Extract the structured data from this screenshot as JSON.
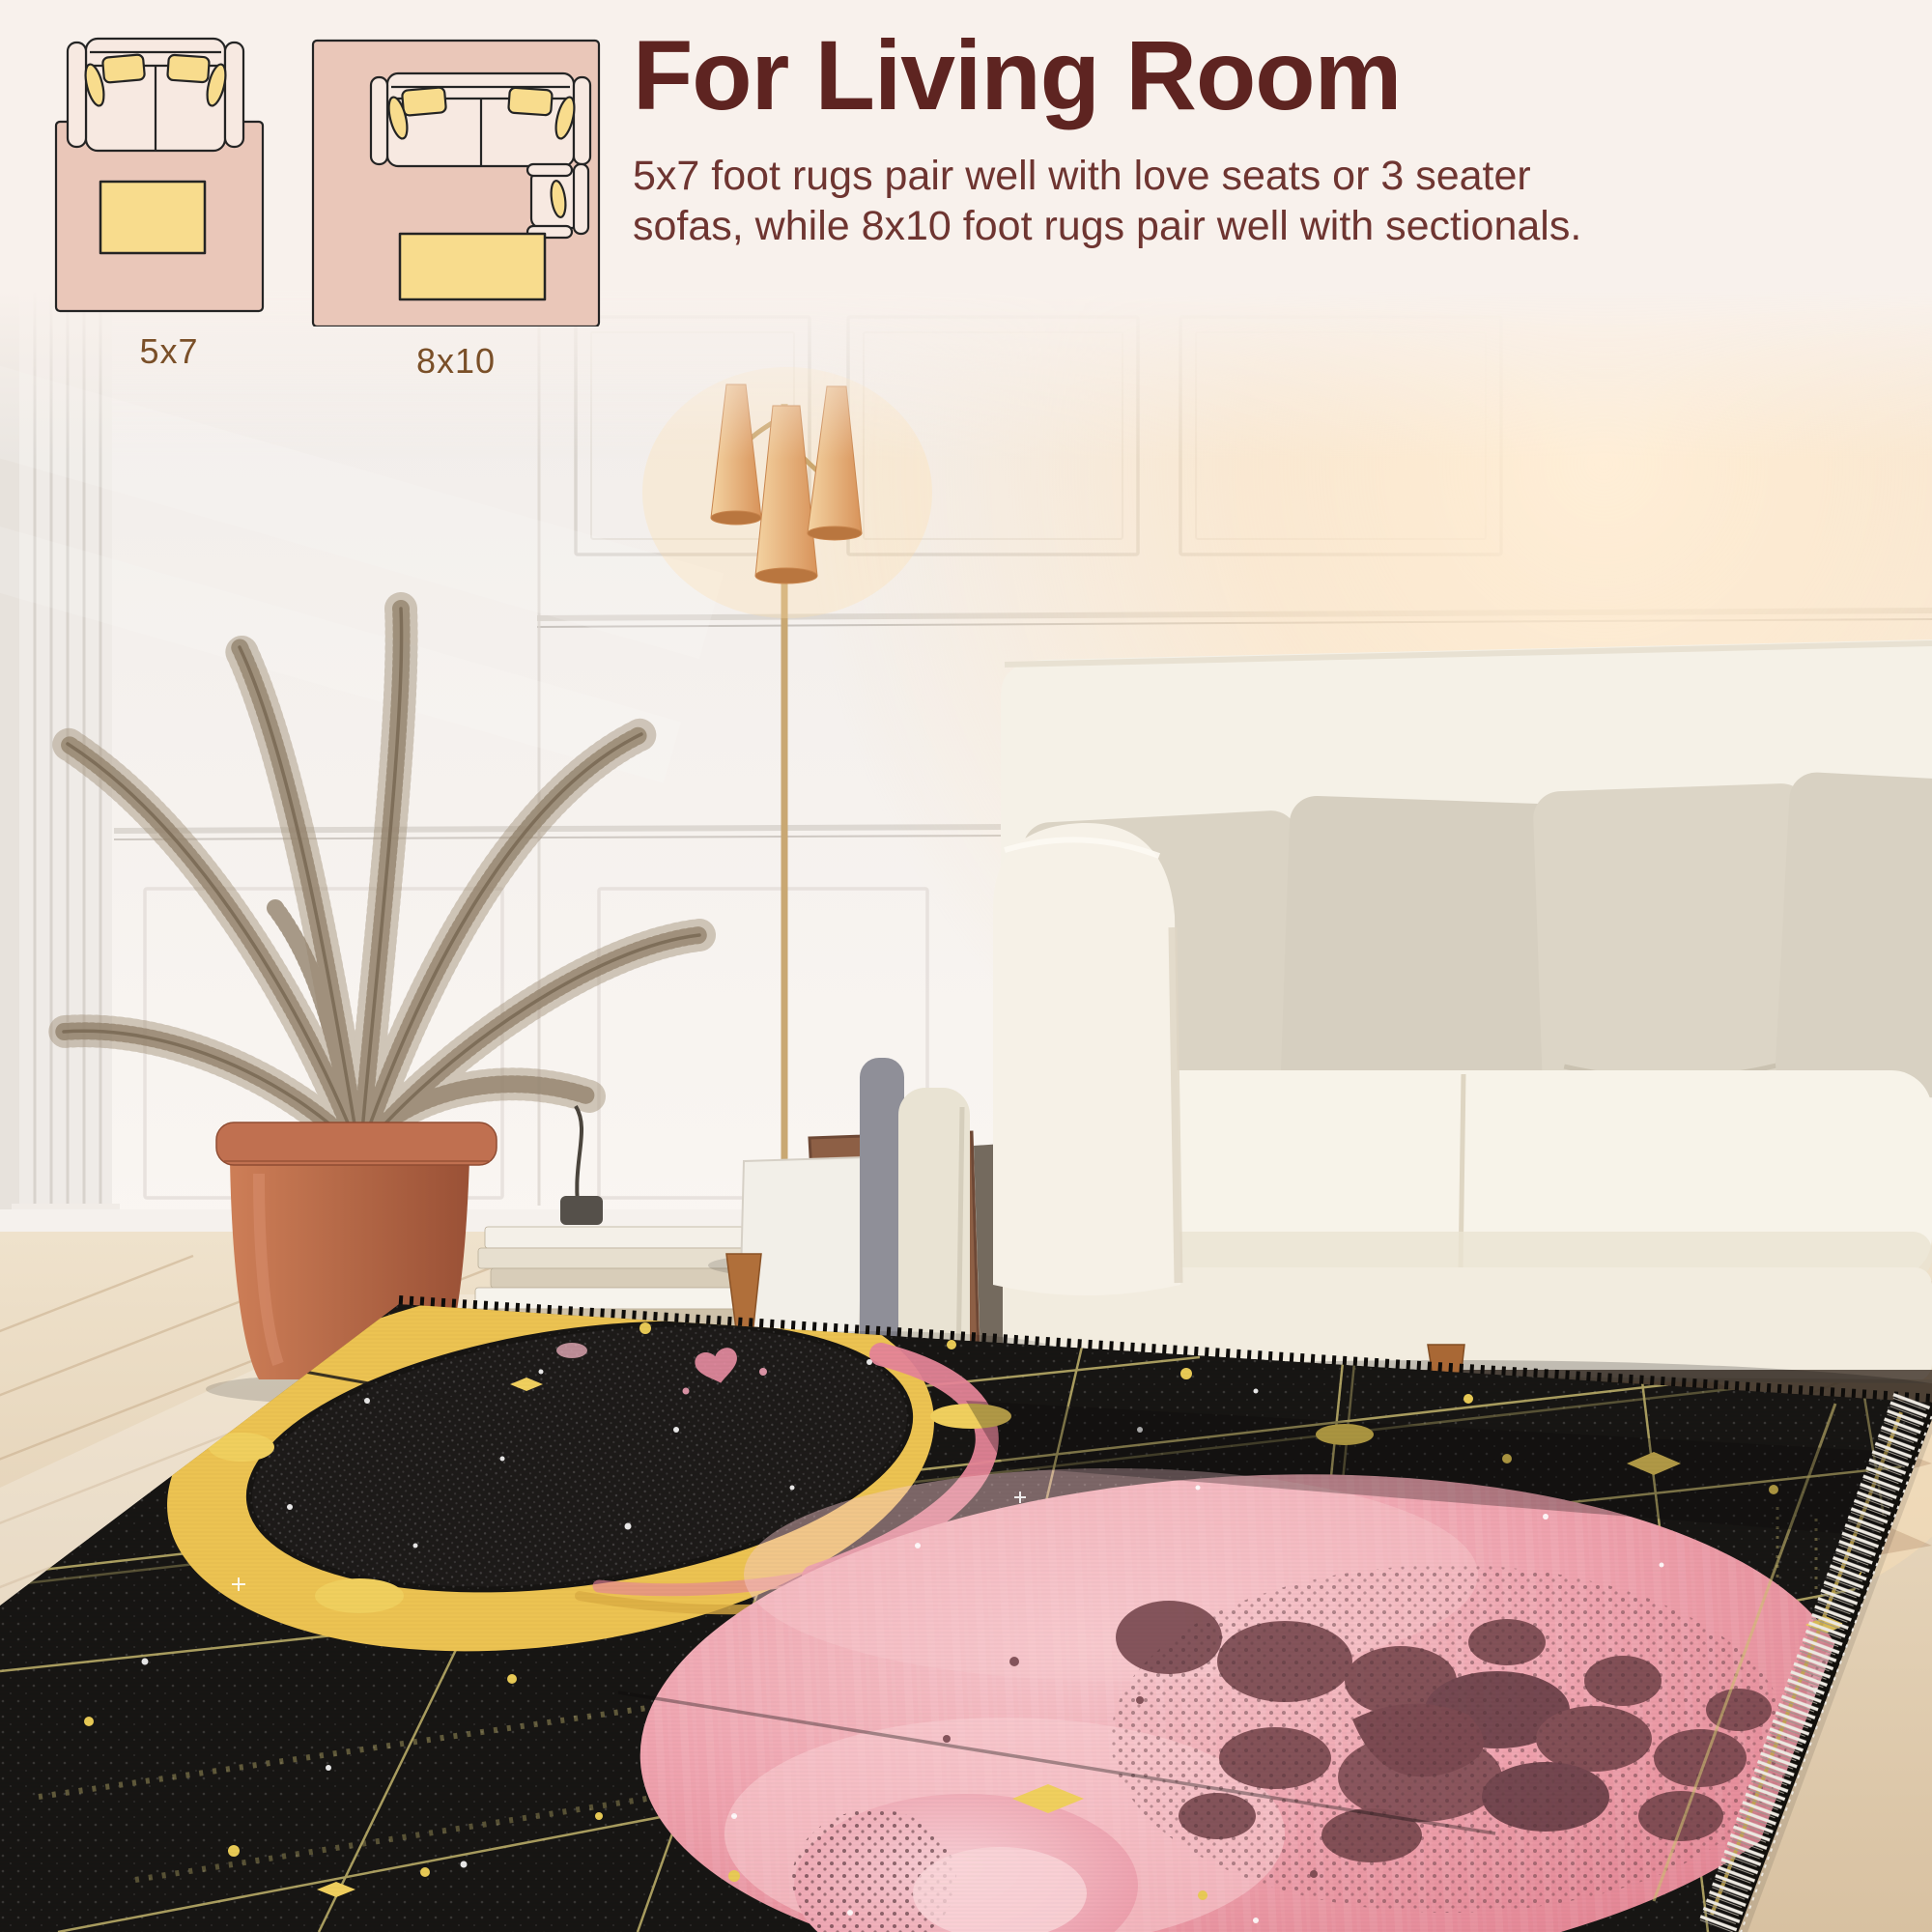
{
  "header": {
    "title": "For Living Room",
    "description": "5x7 foot rugs pair well with love seats or 3 seater sofas, while 8x10 foot rugs pair well with sectionals.",
    "description_lines": [
      "5x7 foot rugs pair well with love seats or 3 seater",
      "sofas, while 8x10 foot rugs pair well with sectionals."
    ]
  },
  "diagrams": [
    {
      "label": "5x7",
      "name": "rug-size-diagram-5x7",
      "furniture": [
        "loveseat-sofa-top-view",
        "coffee-table",
        "area-rug"
      ]
    },
    {
      "label": "8x10",
      "name": "rug-size-diagram-8x10",
      "furniture": [
        "sofa-top-view",
        "coffee-table",
        "armchair-top-view",
        "area-rug"
      ]
    }
  ],
  "scene": {
    "objects": [
      "white-paneled-wall",
      "dried-palm-plant",
      "terracotta-pot",
      "stacked-books",
      "leaning-picture-frames",
      "vases",
      "floor-lamp-three-shades",
      "cream-sofa",
      "beige-throw-pillows",
      "light-wood-floor",
      "black-celestial-rug",
      "yellow-crescent-moon",
      "pink-moon-with-craters",
      "small-pink-moons",
      "gold-stars",
      "rug-fringe"
    ]
  },
  "colors": {
    "band_bg": "#f8f1ec",
    "title_maroon": "#5e2421",
    "body_text": "#6e3531",
    "label_brown": "#7a4f28",
    "diagram_rug_pink": "#eac7b9",
    "diagram_sofa_cream": "#f7e9e1",
    "diagram_yellow": "#f8dc8d",
    "diagram_outline": "#242424",
    "wall_white": "#f3efec",
    "sun_glow": "#ffe4bd",
    "floor_wood": "#e6d7c0",
    "pot_terracotta": "#bb6c4c",
    "plant_dried": "#9a8a76",
    "lamp_shade": "#e8b87e",
    "sofa_cream": "#f6f2e8",
    "pillow_beige": "#d9d2c3",
    "leg_wood": "#ad6c38",
    "rug_black": "#0e0c0a",
    "rug_gold": "#eec34d",
    "rug_grid": "#cdbd6d",
    "rug_pink": "#ee9fab",
    "rug_pink_light": "#f7c9cd",
    "rug_crater": "#6b3a41",
    "rug_rim_pink": "#e48094",
    "fringe_white": "#eae6e0"
  }
}
